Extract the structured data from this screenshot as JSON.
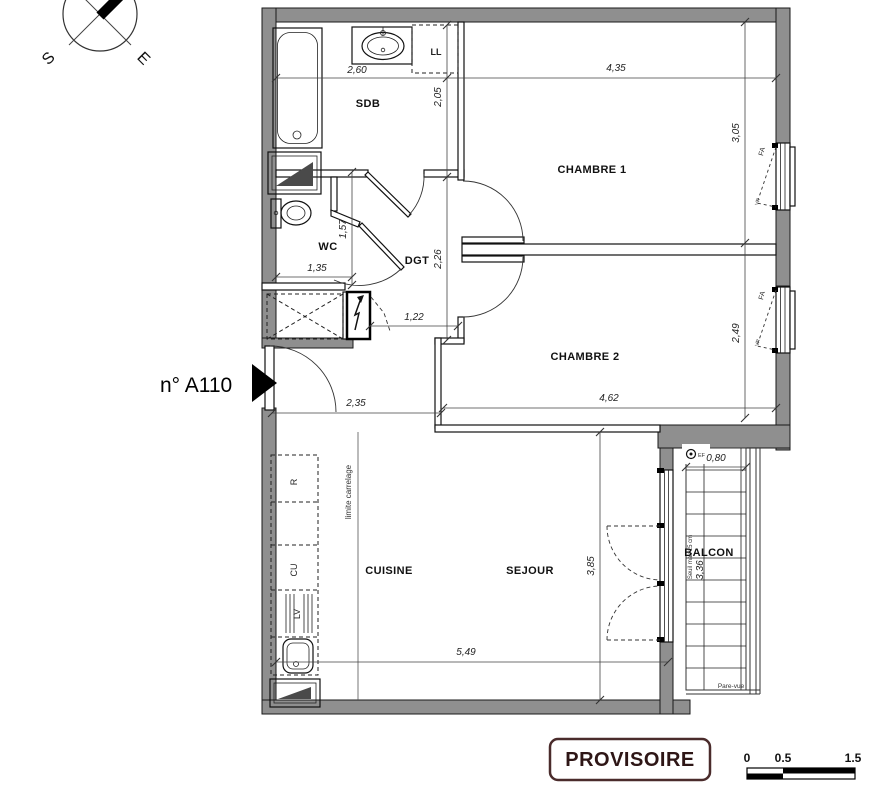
{
  "header": {
    "unit_label": "n° A110",
    "compass": {
      "south": "S",
      "east": "E"
    }
  },
  "rooms": {
    "sdb": "SDB",
    "wc": "WC",
    "dgt": "DGT",
    "chambre1": "CHAMBRE 1",
    "chambre2": "CHAMBRE 2",
    "cuisine": "CUISINE",
    "sejour": "SEJOUR",
    "balcon": "BALCON"
  },
  "fixtures": {
    "washing_machine": "LL",
    "fridge": "R",
    "hob": "CU",
    "dishwasher": "LV",
    "cold_water_tap": "EF"
  },
  "openings": {
    "window1": "FA",
    "window1_shutter": "VR",
    "window2": "FA",
    "window2_shutter": "VR"
  },
  "notes": {
    "tiling_limit": "limite carrelage",
    "threshold": "Seuil max 15 cm",
    "privacy_screen": "Pare-vue"
  },
  "dimensions": {
    "sdb_width": "2,60",
    "sdb_depth": "2,05",
    "chambre1_width": "4,35",
    "chambre1_depth": "3,05",
    "wc_width": "1,35",
    "wc_depth": "1,57",
    "dgt_depth": "2,26",
    "dgt_width": "1,22",
    "entree_width": "2,35",
    "chambre2_width": "4,62",
    "chambre2_depth": "2,49",
    "sejour_width": "5,49",
    "sejour_depth": "3,85",
    "balcon_width": "0,80",
    "balcon_depth": "3,36"
  },
  "footer": {
    "stamp": "PROVISOIRE",
    "scale_bar": {
      "t0": "0",
      "t1": "0.5",
      "t2": "1.5"
    }
  },
  "colors": {
    "wall_gray": "#8f8f8f",
    "stamp_border": "#4a2b2b",
    "stamp_text": "#2e1616"
  }
}
